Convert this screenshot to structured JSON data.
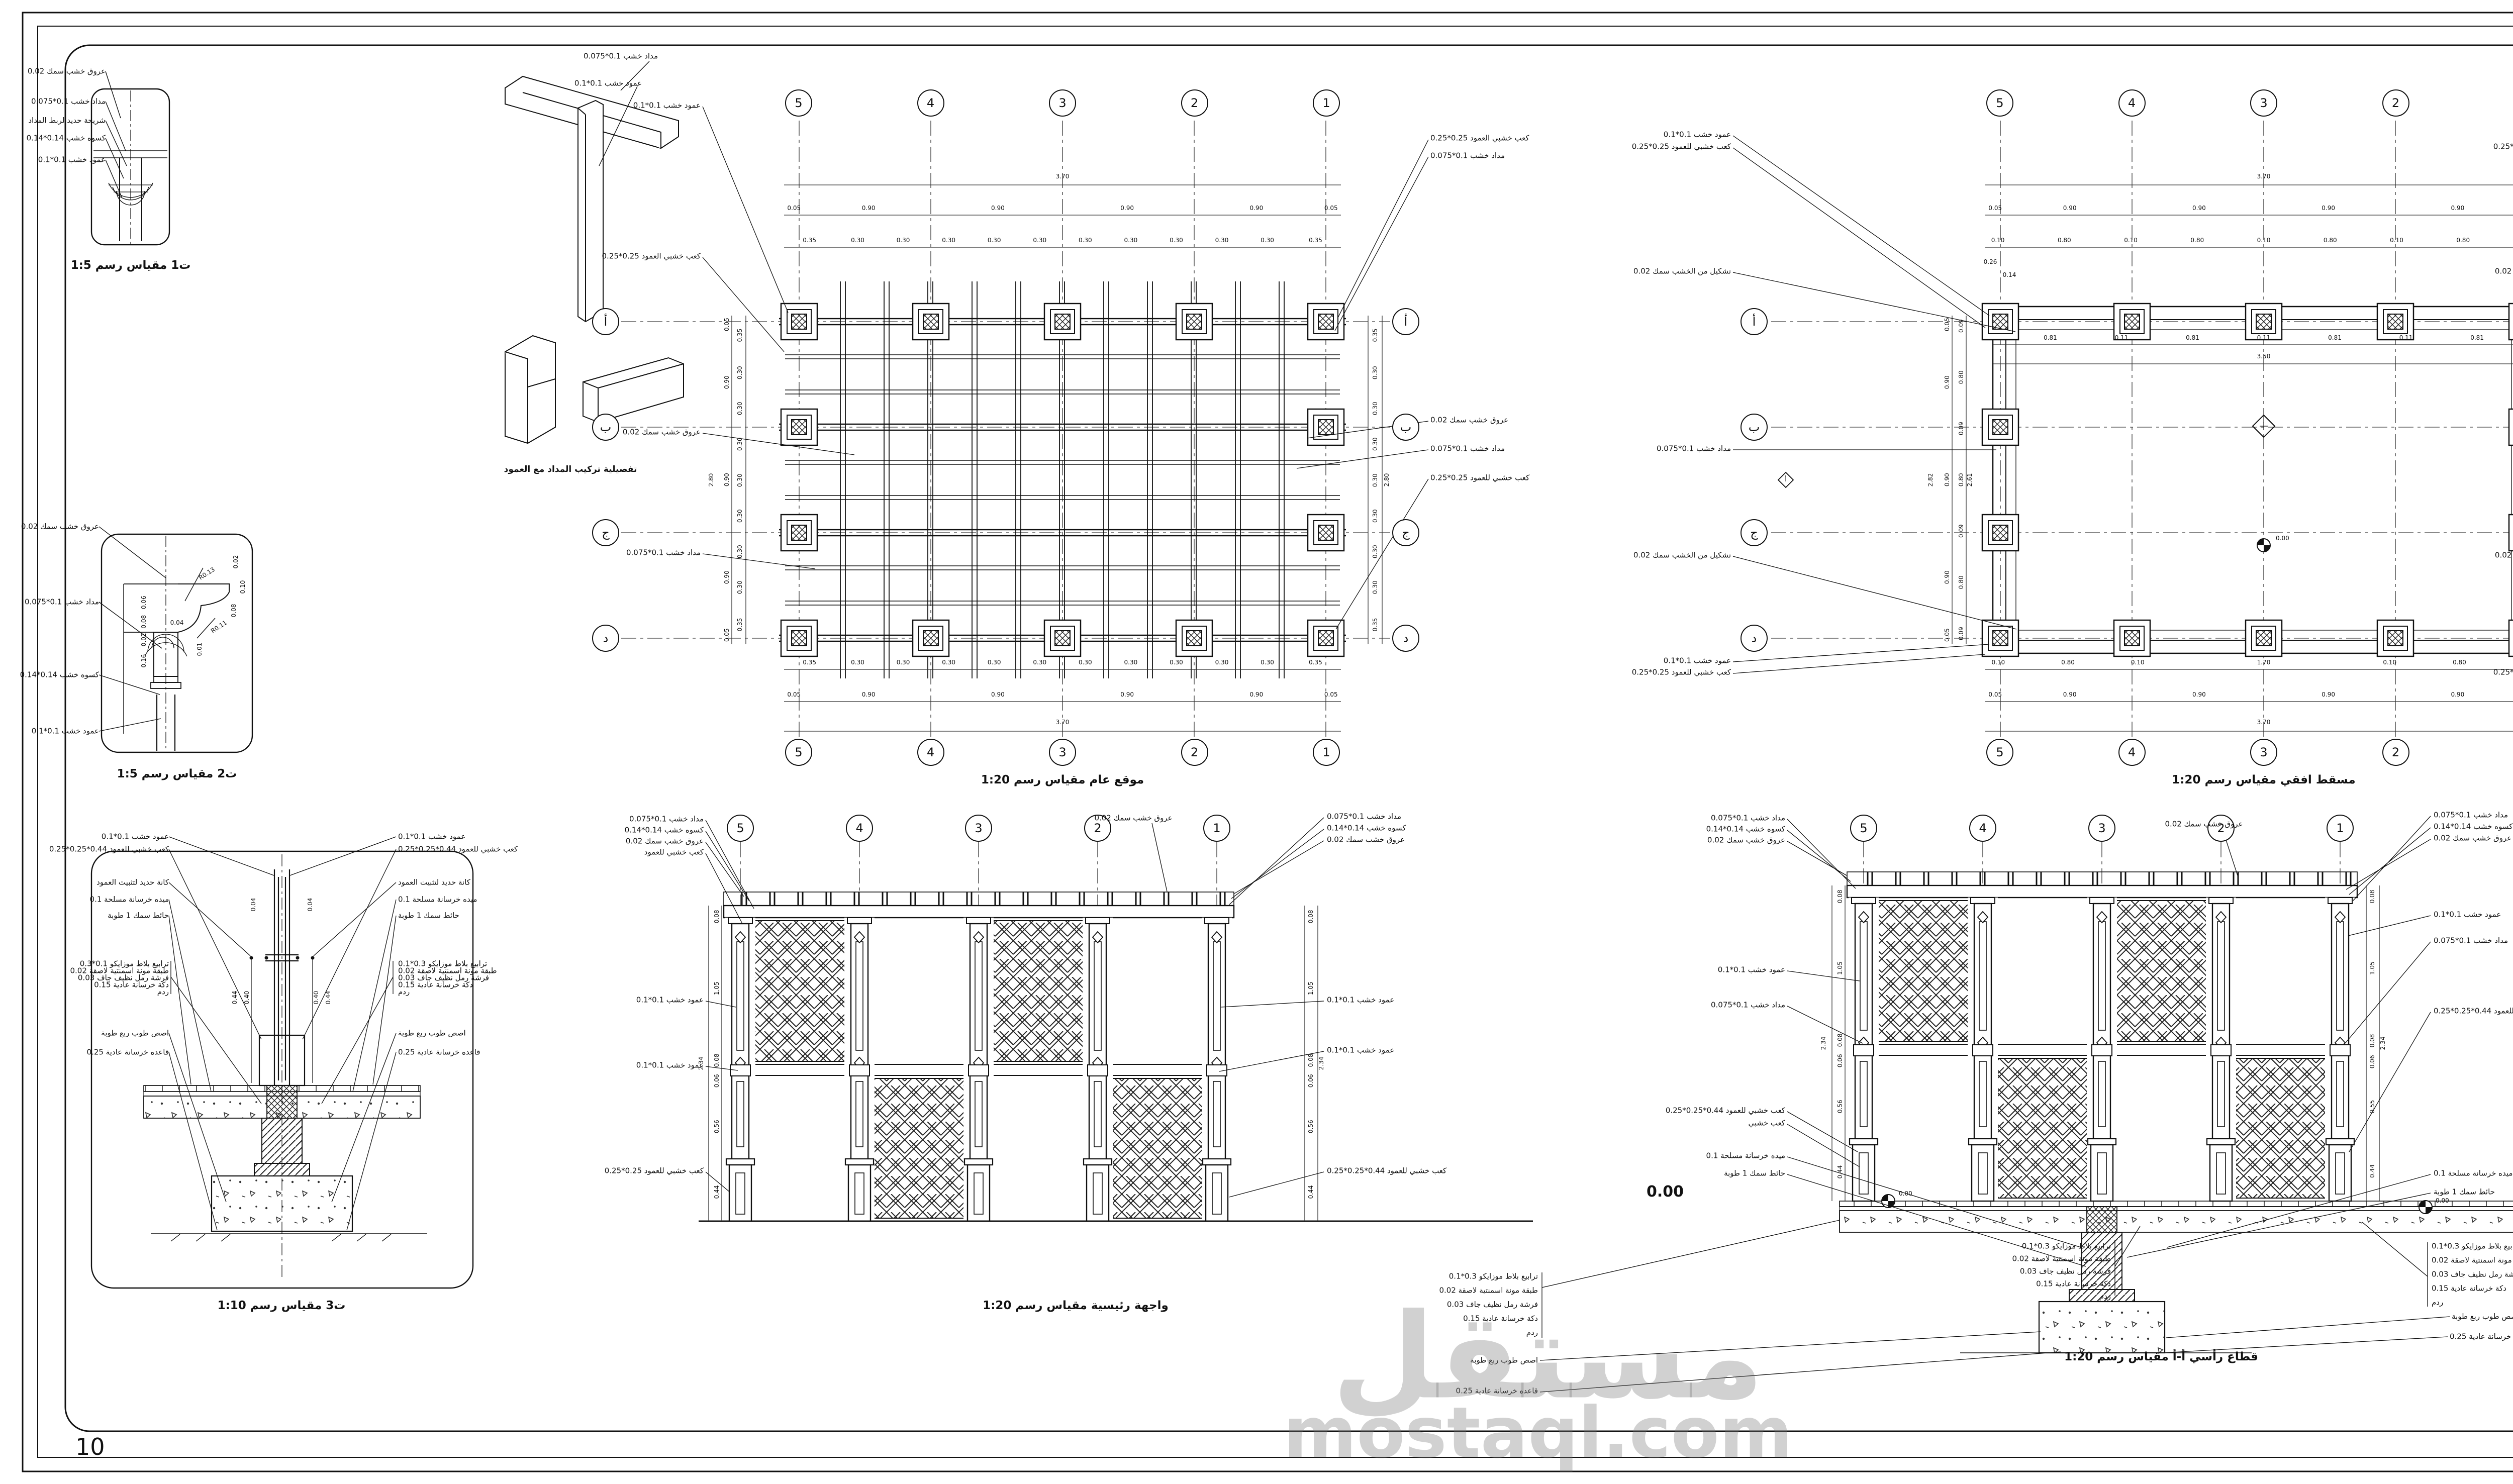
{
  "page": {
    "number": "10"
  },
  "watermark": {
    "arabic": "مستقل",
    "latin": "mostaql.com"
  },
  "axes": {
    "cols": [
      "5",
      "4",
      "3",
      "2",
      "1"
    ],
    "rows": [
      "أ",
      "ب",
      "ج",
      "د"
    ]
  },
  "titleblock": {
    "north_label": "سهم الشمال",
    "table": {
      "title": "جدول الارضيات",
      "headers": [
        "التوصيف",
        "مساحة",
        "باترن",
        "رمز"
      ],
      "row_desc": "ترابيع بلاط موزايكو 0.3*0.1",
      "row_area": "110 م2",
      "row_symbol": "5"
    },
    "logo": {
      "line1": "Mamdouh",
      "line2": "Mostafa",
      "line3": "Designer"
    }
  },
  "t1": {
    "caption": "ت1 مقياس رسم 1:5",
    "labels": [
      "عروق خشب سمك 0.02",
      "مداد خشب 0.1*0.075",
      "شريحة حديد لربط المداد",
      "كسوه خشب 0.14*0.14",
      "عمود خشب 0.1*0.1"
    ]
  },
  "joint3d": {
    "caption": "تفصيلية تركيب المداد مع العمود",
    "labels": [
      "مداد خشب 0.1*0.075",
      "عمود خشب 0.1*0.1"
    ]
  },
  "t2": {
    "caption": "ت2 مقياس رسم 1:5",
    "labels": [
      "عروق خشب سمك 0.02",
      "مداد خشب 0.1*0.075",
      "كسوه خشب 0.14*0.14",
      "عمود خشب 0.1*0.1"
    ],
    "dims_left": [
      "0.06",
      "0.08",
      "0.02",
      "0.16"
    ],
    "dims_right": [
      "0.02",
      "0.10",
      "0.08"
    ],
    "dim_top": "0.04",
    "dim_small": "0.01",
    "radius1": "R0.13",
    "radius2": "R0.11"
  },
  "t3": {
    "caption": "ت3 مقياس رسم 1:10",
    "labels_left": [
      "عمود خشب 0.1*0.1",
      "كعب خشبي للعمود 0.44*0.25*0.25",
      "كانة حديد لتثبيت العمود",
      "ميده خرسانة مسلحة 0.1",
      "حائط سمك 1 طوبة",
      "ترابيع بلاط موزايكو 0.1*0.3",
      "طبقة مونة اسمنتية لاصقة 0.02",
      "فرشة رمل نظيف جاف 0.03",
      "دكة خرسانة عادية 0.15",
      "ردم",
      "اصص طوب ربع طوبة",
      "قاعده خرسانة عادية 0.25"
    ],
    "labels_right": [
      "عمود خشب 0.1*0.1",
      "كعب خشبي للعمود 0.44*0.25*0.25",
      "كانة حديد لتثبيت العمود",
      "ميده خرسانة مسلحة 0.1",
      "حائط سمك 1 طوبة",
      "ترابيع بلاط موزايكو 0.3*0.1",
      "طبقة مونة اسمنتية لاصقة 0.02",
      "فرشة رمل نظيف جاف 0.03",
      "دكة خرسانة عادية 0.15",
      "ردم",
      "اصص طوب ربع طوبة",
      "قاعده خرسانة عادية 0.25"
    ],
    "dim_004": "0.04",
    "dim_044": "0.44",
    "dim_040": "0.40"
  },
  "siteplan": {
    "caption": "موقع عام مقياس رسم 1:20",
    "dim_total_h": "3.70",
    "dims_h_major": [
      "0.05",
      "0.90",
      "0.90",
      "0.90",
      "0.90",
      "0.05"
    ],
    "dims_h_minor": [
      "0.35",
      "0.30",
      "0.30",
      "0.30",
      "0.30",
      "0.30",
      "0.30",
      "0.30",
      "0.30",
      "0.30",
      "0.30",
      "0.35"
    ],
    "dim_total_v": "2.80",
    "dims_v_major": [
      "0.05",
      "0.90",
      "0.90",
      "0.90",
      "0.05"
    ],
    "dims_v_minor": [
      "0.35",
      "0.30",
      "0.30",
      "0.30",
      "0.30",
      "0.30",
      "0.30",
      "0.30",
      "0.35"
    ],
    "labels_left": [
      "عمود خشب 0.1*0.1",
      "كعب خشبي العمود 0.25*0.25",
      "عروق خشب سمك 0.02",
      "مداد خشب 0.1*0.075"
    ],
    "labels_right": [
      "كعب خشبي العمود 0.25*0.25",
      "مداد خشب 0.1*0.075",
      "عروق خشب سمك 0.02",
      "مداد خشب 0.1*0.075",
      "كعب خشبي للعمود 0.25*0.25"
    ]
  },
  "floorplan": {
    "caption": "مسقط افقي مقياس رسم 1:20",
    "dim_total_h": "3.70",
    "dims_h_major": [
      "0.05",
      "0.90",
      "0.90",
      "0.90",
      "0.90",
      "0.05"
    ],
    "dims_h_minor": [
      "0.10",
      "0.80",
      "0.10",
      "0.80",
      "0.10",
      "0.80",
      "0.10",
      "0.80",
      "0.10"
    ],
    "dims_h_inner": [
      "0.81",
      "0.11",
      "0.81",
      "0.11",
      "0.81",
      "0.11",
      "0.81"
    ],
    "dim_350": "3.50",
    "dims_h_bottom": [
      "0.10",
      "0.80",
      "0.10",
      "1.70",
      "0.10",
      "0.80",
      "0.10"
    ],
    "dims_v_outer": [
      "0.05",
      "0.90",
      "0.90",
      "0.90",
      "0.05"
    ],
    "dims_v_inner": [
      "0.09",
      "0.80",
      "0.09",
      "0.80",
      "0.09",
      "0.80",
      "0.09"
    ],
    "dim_282": "2.82",
    "dim_261": "2.61",
    "dim_026": "0.26",
    "dim_014": "0.14",
    "level": "0.00",
    "section_marker": "أ",
    "labels_left": [
      "عمود خشب 0.1*0.1",
      "كعب خشبي للعمود 0.25*0.25",
      "تشكيل من الخشب سمك 0.02",
      "مداد خشب 0.1*0.075",
      "تشكيل من الخشب سمك 0.02",
      "عمود خشب 0.1*0.1",
      "كعب خشبي للعمود 0.25*0.25"
    ]
  },
  "elevation": {
    "caption": "واجهة رئيسية مقياس رسم 1:20",
    "label_top": "عروق خشب سمك 0.02",
    "labels_left": [
      "مداد خشب 0.1*0.075",
      "كسوه خشب 0.14*0.14",
      "عروق خشب سمك 0.02",
      "كعب خشبي للعمود",
      "عمود خشب 0.1*0.1",
      "عمود خشب 0.1*0.1",
      "كعب خشبي للعمود 0.25*0.25"
    ],
    "labels_right": [
      "مداد خشب 0.1*0.075",
      "كسوه خشب 0.14*0.14",
      "عروق خشب سمك 0.02",
      "عمود خشب 0.1*0.1",
      "عمود خشب 0.1*0.1",
      "كعب خشبي للعمود 0.44*0.25*0.25"
    ],
    "dims_v": [
      "0.08",
      "1.05",
      "0.08",
      "0.06",
      "0.56",
      "0.44"
    ],
    "dim_total": "2.34"
  },
  "section": {
    "caption": "قطاع رأسي أ-أ مقياس رسم 1:20",
    "label_top": "عروق خشب سمك 0.02",
    "level": "0.00",
    "labels_left": [
      "مداد خشب 0.1*0.075",
      "كسوه خشب 0.14*0.14",
      "عروق خشب سمك 0.02",
      "عمود خشب 0.1*0.1",
      "مداد خشب 0.1*0.075",
      "كعب خشبي للعمود 0.44*0.25*0.25",
      "كعب خشبي",
      "ميده خرسانة مسلحة 0.1",
      "حائط سمك 1 طوبة"
    ],
    "labels_right": [
      "مداد خشب 0.1*0.075",
      "كسوه خشب 0.14*0.14",
      "عروق خشب سمك 0.02",
      "عمود خشب 0.1*0.1",
      "مداد خشب 0.1*0.075",
      "كعب خشبي للعمود 0.44*0.25*0.25",
      "ميده خرسانة مسلحة 0.1",
      "حائط سمك 1 طوبة"
    ],
    "layers": [
      "ترابيع بلاط موزايكو 0.3*0.1",
      "طبقة مونة اسمنتية لاصقة 0.02",
      "فرشة رمل نظيف جاف 0.03",
      "دكة خرسانة عادية 0.15",
      "ردم"
    ],
    "pot": "اصص طوب ربع طوبة",
    "base": "قاعده خرسانة عادية 0.25",
    "dims_v": [
      "0.08",
      "1.05",
      "0.08",
      "0.06",
      "0.56",
      "0.44"
    ],
    "dims_v_right": [
      "0.08",
      "1.05",
      "0.08",
      "0.06",
      "0.55",
      "0.44"
    ],
    "dim_total": "2.34"
  }
}
